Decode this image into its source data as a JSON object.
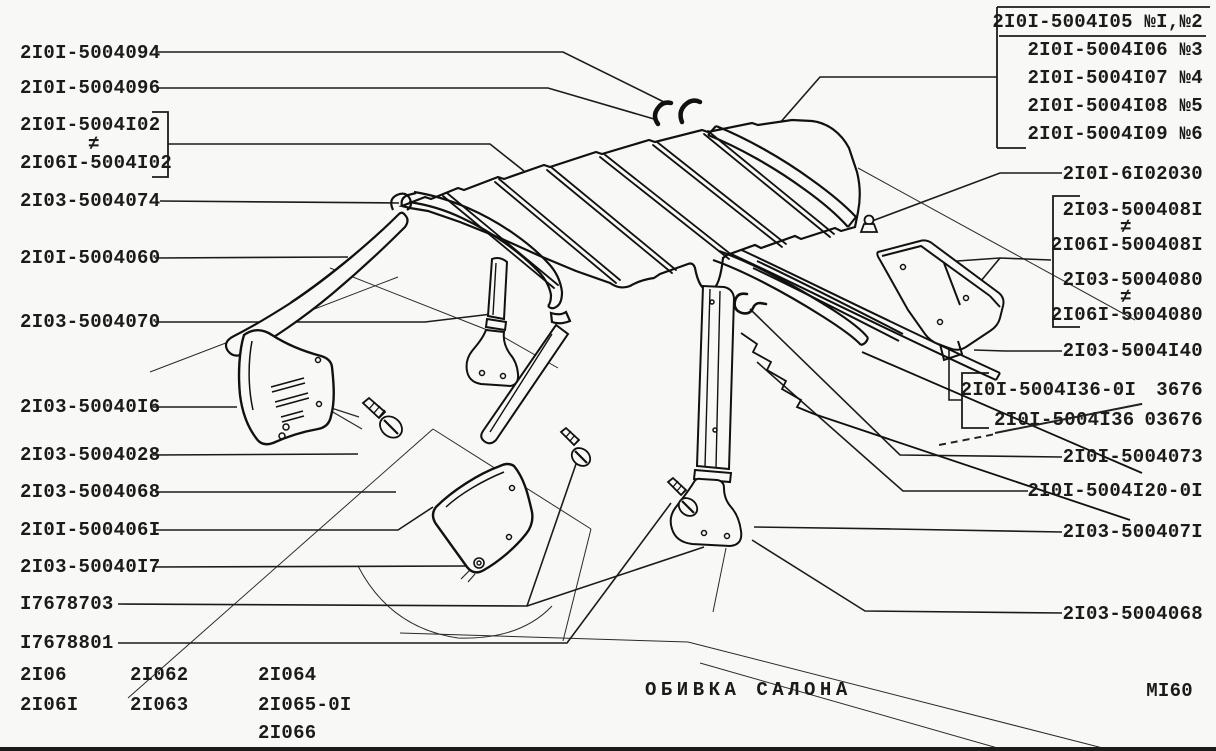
{
  "page": {
    "background": "#f8f8f6",
    "ink_color": "#1b1b1b"
  },
  "footer": {
    "title": "ОБИВКА САЛОНА",
    "sheet_code": "МI60"
  },
  "models": {
    "col1": [
      "2I06",
      "2I06I"
    ],
    "col2": [
      "2I062",
      "2I063"
    ],
    "col3": [
      "2I064",
      "2I065-0I",
      "2I066"
    ]
  },
  "labels": {
    "neq": "≠",
    "left": [
      {
        "part": "2I0I-5004094"
      },
      {
        "part": "2I0I-5004096"
      },
      {
        "part": "2I0I-5004I02"
      },
      {
        "part": "2I06I-5004I02"
      },
      {
        "part": "2I03-5004074"
      },
      {
        "part": "2I0I-5004060"
      },
      {
        "part": "2I03-5004070"
      },
      {
        "part": "2I03-50040I6"
      },
      {
        "part": "2I03-5004028"
      },
      {
        "part": "2I03-5004068"
      },
      {
        "part": "2I0I-500406I"
      },
      {
        "part": "2I03-50040I7"
      },
      {
        "part": "I7678703"
      },
      {
        "part": "I7678801"
      }
    ],
    "top_right_group": [
      "2I0I-5004I05 №I,№2",
      "2I0I-5004I06 №3",
      "2I0I-5004I07 №4",
      "2I0I-5004I08 №5",
      "2I0I-5004I09 №6"
    ],
    "right": [
      {
        "part": "2I0I-6I02030"
      },
      {
        "part": "2I03-500408I"
      },
      {
        "part": "2I06I-500408I"
      },
      {
        "part": "2I03-5004080"
      },
      {
        "part": "2I06I-5004080"
      },
      {
        "part": "2I03-5004I40"
      },
      {
        "part": "2I0I-5004I36-0I",
        "note": "3676"
      },
      {
        "part": "2I0I-5004I36",
        "note": "03676",
        "struck_out": true
      },
      {
        "part": "2I0I-5004073"
      },
      {
        "part": "2I0I-5004I20-0I"
      },
      {
        "part": "2I03-500407I"
      },
      {
        "part": "2I03-5004068"
      }
    ]
  }
}
